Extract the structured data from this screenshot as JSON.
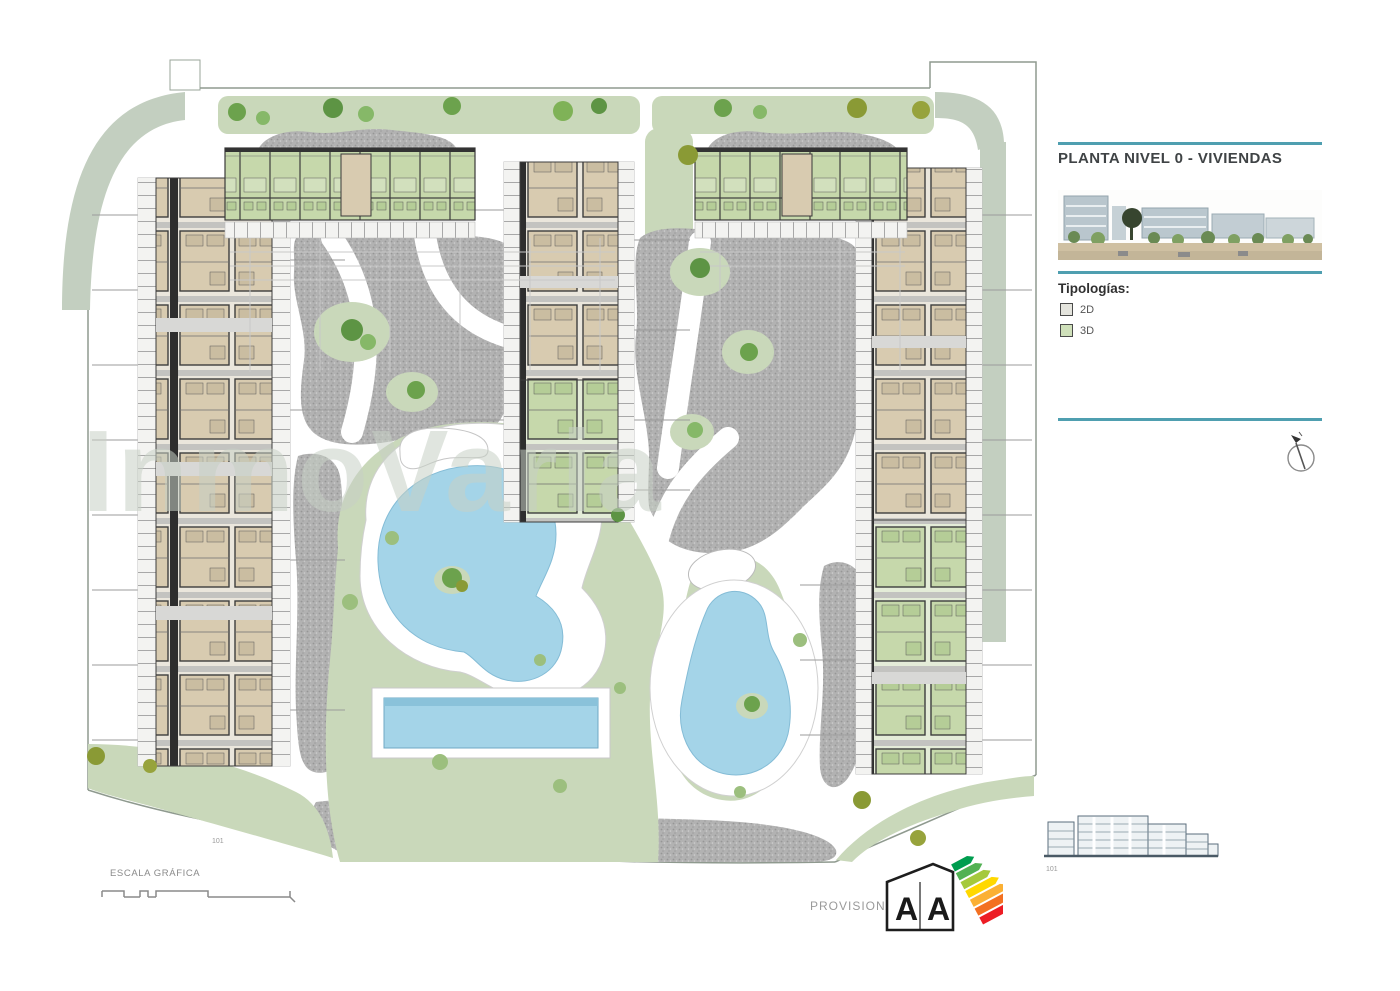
{
  "sidebar": {
    "accent_color": "#4f9fb0",
    "title": "PLANTA NIVEL 0 - VIVIENDAS",
    "tipologias": {
      "heading": "Tipologías:",
      "items": [
        {
          "label": "2D",
          "swatch_color": "#e4e4dd"
        },
        {
          "label": "3D",
          "swatch_color": "#cfe0ba"
        }
      ]
    }
  },
  "plan": {
    "watermark": "InmoVaria",
    "ref_number": "101",
    "colors": {
      "lawn": "#c9d8ba",
      "boundary_band": "#c3cfc0",
      "paving_gray": "#b2b2b2",
      "pool_water": "#a4d4e8",
      "unit_2d_fill": "#d8cbb0",
      "unit_3d_fill": "#c6d8ab"
    }
  },
  "elevation": {
    "ref_number": "101"
  },
  "footer": {
    "scale_label": "ESCALA GRÁFICA",
    "provisional_label": "PROVISIONAL",
    "energy": {
      "left_letter": "A",
      "right_letter": "A"
    }
  }
}
